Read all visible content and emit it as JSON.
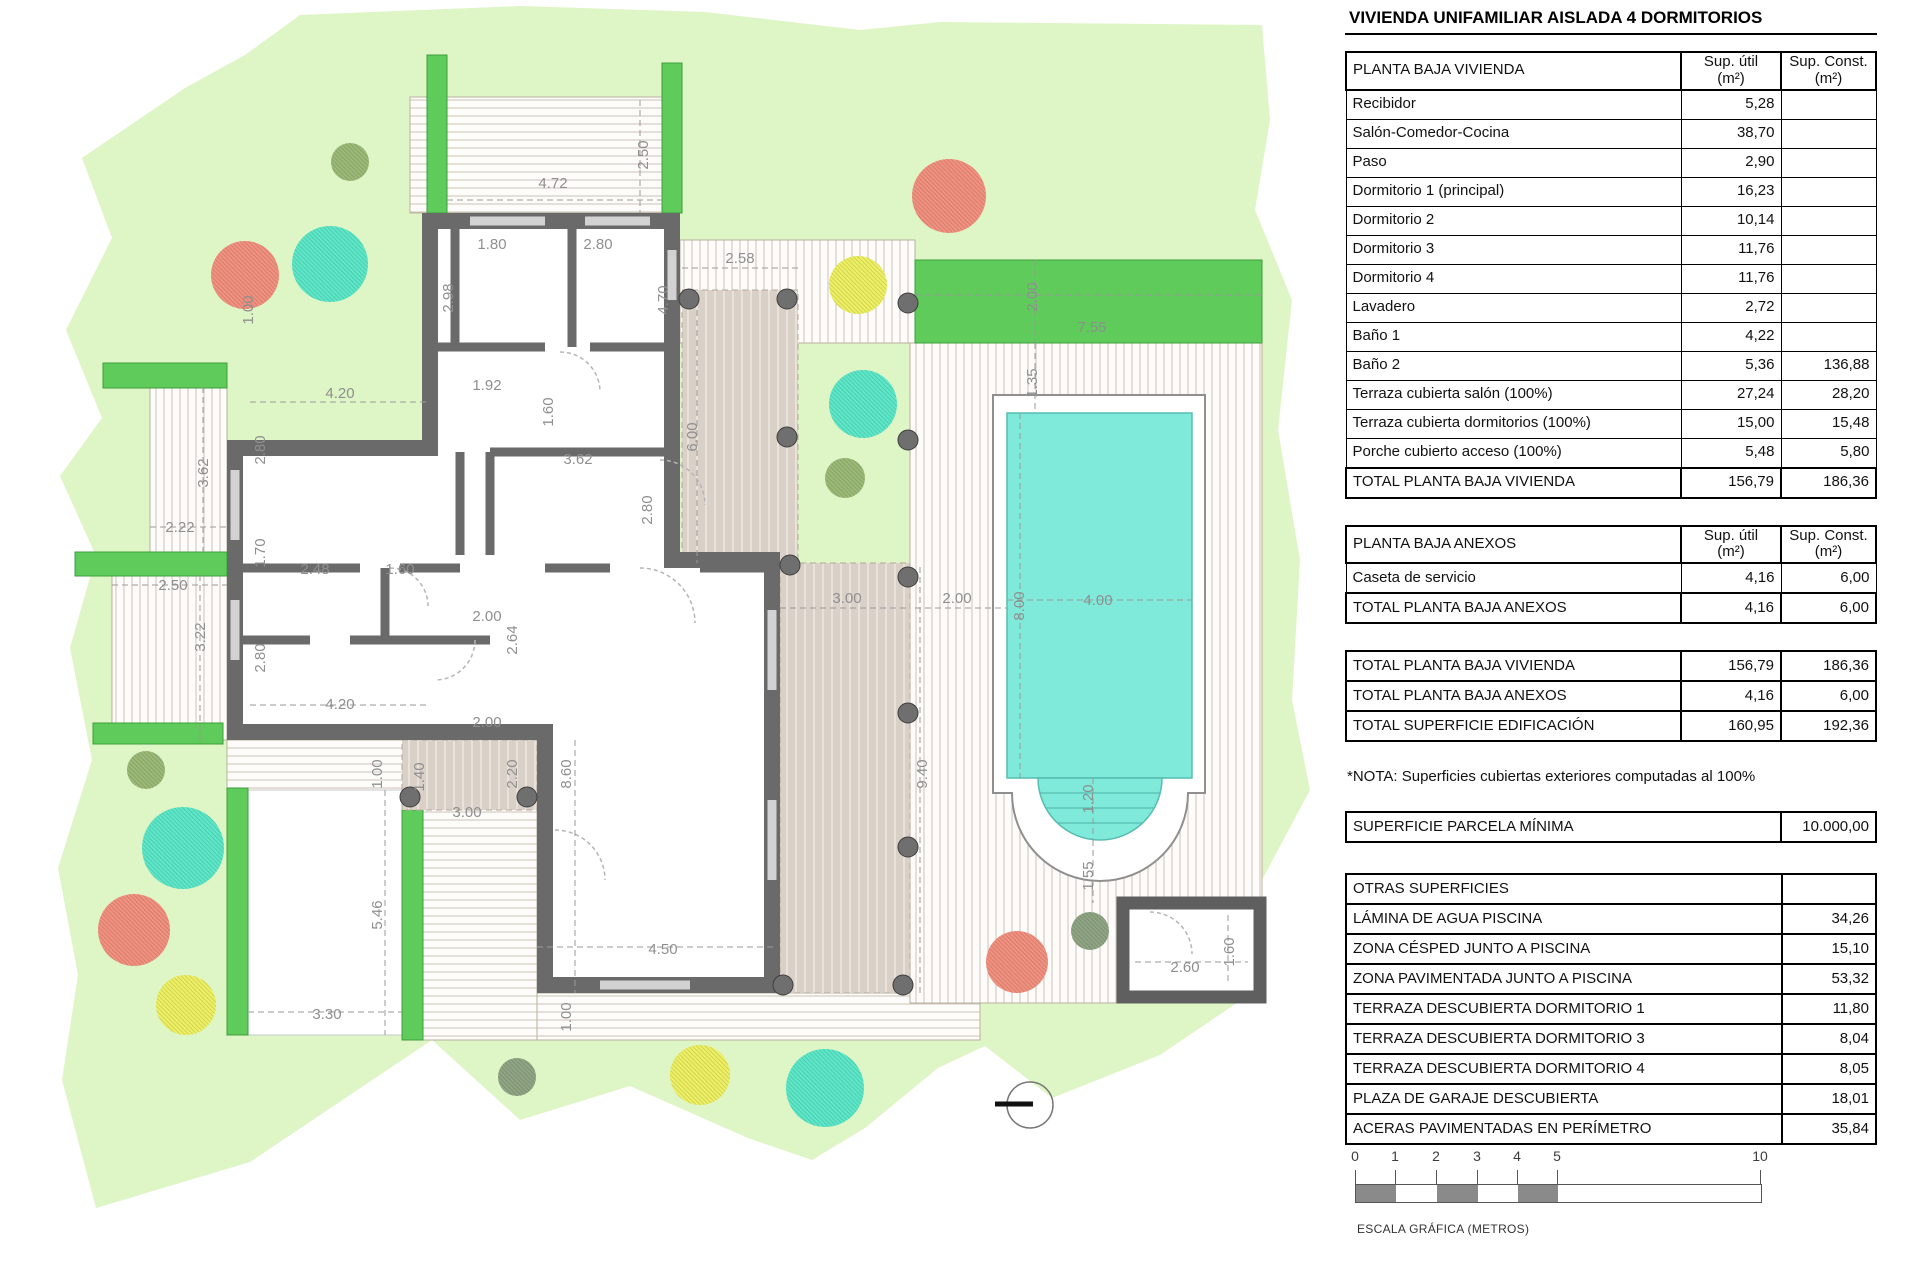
{
  "title": "VIVIENDA UNIFAMILIAR AISLADA 4 DORMITORIOS",
  "col_headers": {
    "util": "Sup. útil",
    "const": "Sup. Const.",
    "unit": "(m²)"
  },
  "planta_baja_vivienda": {
    "label": "PLANTA BAJA VIVIENDA",
    "rows": [
      {
        "label": "Recibidor",
        "util": "5,28",
        "const": ""
      },
      {
        "label": "Salón-Comedor-Cocina",
        "util": "38,70",
        "const": ""
      },
      {
        "label": "Paso",
        "util": "2,90",
        "const": ""
      },
      {
        "label": "Dormitorio 1 (principal)",
        "util": "16,23",
        "const": ""
      },
      {
        "label": "Dormitorio 2",
        "util": "10,14",
        "const": ""
      },
      {
        "label": "Dormitorio 3",
        "util": "11,76",
        "const": ""
      },
      {
        "label": "Dormitorio 4",
        "util": "11,76",
        "const": ""
      },
      {
        "label": "Lavadero",
        "util": "2,72",
        "const": ""
      },
      {
        "label": "Baño 1",
        "util": "4,22",
        "const": ""
      },
      {
        "label": "Baño 2",
        "util": "5,36",
        "const": "136,88"
      },
      {
        "label": "Terraza cubierta salón (100%)",
        "util": "27,24",
        "const": "28,20"
      },
      {
        "label": "Terraza cubierta dormitorios (100%)",
        "util": "15,00",
        "const": "15,48"
      },
      {
        "label": "Porche cubierto acceso (100%)",
        "util": "5,48",
        "const": "5,80"
      }
    ],
    "total": {
      "label": "TOTAL PLANTA BAJA VIVIENDA",
      "util": "156,79",
      "const": "186,36"
    }
  },
  "planta_baja_anexos": {
    "label": "PLANTA BAJA ANEXOS",
    "rows": [
      {
        "label": "Caseta de servicio",
        "util": "4,16",
        "const": "6,00"
      }
    ],
    "total": {
      "label": "TOTAL PLANTA BAJA ANEXOS",
      "util": "4,16",
      "const": "6,00"
    }
  },
  "resumen": {
    "rows": [
      {
        "label": "TOTAL PLANTA BAJA VIVIENDA",
        "util": "156,79",
        "const": "186,36",
        "hl": false
      },
      {
        "label": "TOTAL PLANTA BAJA ANEXOS",
        "util": "4,16",
        "const": "6,00",
        "hl": false
      },
      {
        "label": "TOTAL SUPERFICIE EDIFICACIÓN",
        "util": "160,95",
        "const": "192,36",
        "hl": true
      }
    ]
  },
  "nota": "*NOTA: Superficies cubiertas exteriores computadas al 100%",
  "parcela": {
    "label": "SUPERFICIE PARCELA MÍNIMA",
    "value": "10.000,00"
  },
  "otras": {
    "label": "OTRAS SUPERFICIES",
    "rows": [
      {
        "label": "LÁMINA DE AGUA PISCINA",
        "value": "34,26"
      },
      {
        "label": "ZONA CÉSPED JUNTO A PISCINA",
        "value": "15,10"
      },
      {
        "label": "ZONA PAVIMENTADA JUNTO A PISCINA",
        "value": "53,32"
      },
      {
        "label": "TERRAZA DESCUBIERTA DORMITORIO 1",
        "value": "11,80"
      },
      {
        "label": "TERRAZA DESCUBIERTA DORMITORIO 3",
        "value": "8,04"
      },
      {
        "label": "TERRAZA DESCUBIERTA DORMITORIO 4",
        "value": "8,05"
      },
      {
        "label": "PLAZA DE GARAJE DESCUBIERTA",
        "value": "18,01"
      },
      {
        "label": "ACERAS PAVIMENTADAS EN PERÍMETRO",
        "value": "35,84"
      }
    ]
  },
  "scalebar": {
    "ticks": [
      {
        "label": "0",
        "x": 0
      },
      {
        "label": "1",
        "x": 40
      },
      {
        "label": "2",
        "x": 81
      },
      {
        "label": "3",
        "x": 122
      },
      {
        "label": "4",
        "x": 162
      },
      {
        "label": "5",
        "x": 202
      },
      {
        "label": "10",
        "x": 405
      }
    ],
    "segments": [
      {
        "x": 0,
        "w": 40
      },
      {
        "x": 81,
        "w": 41
      },
      {
        "x": 162,
        "w": 40
      }
    ],
    "caption": "ESCALA GRÁFICA (METROS)"
  },
  "colors": {
    "lawn": "#def5c5",
    "hedge_green": "#5ecb5b",
    "pool_water": "#7feada",
    "wall_gray": "#6a6a6a",
    "table_beige": "#eae8d9",
    "table_blue": "#cfe9f3",
    "tree_red": "#f29180",
    "tree_teal": "#5ce8c8",
    "tree_yellow": "#eef063",
    "tree_olive": "#9cba77",
    "tree_olive2": "#8fa584"
  },
  "plan": {
    "dimensions": [
      {
        "t": "4.72",
        "x": 553,
        "y": 188,
        "r": 0
      },
      {
        "t": "2.50",
        "x": 648,
        "y": 155,
        "r": -90
      },
      {
        "t": "1.80",
        "x": 492,
        "y": 249,
        "r": 0
      },
      {
        "t": "2.80",
        "x": 598,
        "y": 249,
        "r": 0
      },
      {
        "t": "2.58",
        "x": 740,
        "y": 263,
        "r": 0
      },
      {
        "t": "2.98",
        "x": 453,
        "y": 298,
        "r": -90
      },
      {
        "t": "4.70",
        "x": 668,
        "y": 300,
        "r": -90
      },
      {
        "t": "1.00",
        "x": 253,
        "y": 310,
        "r": -90
      },
      {
        "t": "4.20",
        "x": 340,
        "y": 398,
        "r": 0
      },
      {
        "t": "1.92",
        "x": 487,
        "y": 390,
        "r": 0
      },
      {
        "t": "1.60",
        "x": 553,
        "y": 412,
        "r": -90
      },
      {
        "t": "6.00",
        "x": 697,
        "y": 437,
        "r": -90
      },
      {
        "t": "3.62",
        "x": 578,
        "y": 464,
        "r": 0
      },
      {
        "t": "2.80",
        "x": 265,
        "y": 450,
        "r": -90
      },
      {
        "t": "3.62",
        "x": 208,
        "y": 473,
        "r": -90
      },
      {
        "t": "2.80",
        "x": 652,
        "y": 510,
        "r": -90
      },
      {
        "t": "2.22",
        "x": 180,
        "y": 532,
        "r": 0
      },
      {
        "t": "1.70",
        "x": 265,
        "y": 553,
        "r": -90
      },
      {
        "t": "2.48",
        "x": 315,
        "y": 574,
        "r": 0
      },
      {
        "t": "1.60",
        "x": 400,
        "y": 574,
        "r": 0
      },
      {
        "t": "2.50",
        "x": 173,
        "y": 590,
        "r": 0
      },
      {
        "t": "2.00",
        "x": 487,
        "y": 621,
        "r": 0
      },
      {
        "t": "3.00",
        "x": 847,
        "y": 603,
        "r": 0
      },
      {
        "t": "2.00",
        "x": 957,
        "y": 603,
        "r": 0
      },
      {
        "t": "8.00",
        "x": 1024,
        "y": 606,
        "r": -90
      },
      {
        "t": "4.00",
        "x": 1098,
        "y": 605,
        "r": 0
      },
      {
        "t": "3.22",
        "x": 205,
        "y": 637,
        "r": -90
      },
      {
        "t": "2.80",
        "x": 265,
        "y": 658,
        "r": -90
      },
      {
        "t": "2.64",
        "x": 517,
        "y": 640,
        "r": -90
      },
      {
        "t": "4.20",
        "x": 340,
        "y": 709,
        "r": 0
      },
      {
        "t": "2.00",
        "x": 487,
        "y": 727,
        "r": 0
      },
      {
        "t": "9.40",
        "x": 927,
        "y": 774,
        "r": -90
      },
      {
        "t": "1.00",
        "x": 382,
        "y": 774,
        "r": -90
      },
      {
        "t": "1.40",
        "x": 424,
        "y": 777,
        "r": -90
      },
      {
        "t": "2.20",
        "x": 517,
        "y": 774,
        "r": -90
      },
      {
        "t": "8.60",
        "x": 571,
        "y": 774,
        "r": -90
      },
      {
        "t": "3.00",
        "x": 467,
        "y": 817,
        "r": 0
      },
      {
        "t": "5.46",
        "x": 382,
        "y": 915,
        "r": -90
      },
      {
        "t": "4.50",
        "x": 663,
        "y": 954,
        "r": 0
      },
      {
        "t": "1.20",
        "x": 1093,
        "y": 799,
        "r": -90
      },
      {
        "t": "1.55",
        "x": 1093,
        "y": 876,
        "r": -90
      },
      {
        "t": "2.60",
        "x": 1185,
        "y": 972,
        "r": 0
      },
      {
        "t": "1.60",
        "x": 1234,
        "y": 952,
        "r": -90
      },
      {
        "t": "3.30",
        "x": 327,
        "y": 1019,
        "r": 0
      },
      {
        "t": "1.00",
        "x": 571,
        "y": 1017,
        "r": -90
      },
      {
        "t": "7.55",
        "x": 1092,
        "y": 332,
        "r": 0
      },
      {
        "t": "2.00",
        "x": 1037,
        "y": 297,
        "r": -90
      },
      {
        "t": "1.35",
        "x": 1037,
        "y": 383,
        "r": -90
      }
    ],
    "trees": [
      {
        "x": 350,
        "y": 162,
        "r": 19,
        "c": "tree_olive"
      },
      {
        "x": 245,
        "y": 275,
        "r": 34,
        "c": "tree_red"
      },
      {
        "x": 330,
        "y": 264,
        "r": 38,
        "c": "tree_teal"
      },
      {
        "x": 949,
        "y": 196,
        "r": 37,
        "c": "tree_red"
      },
      {
        "x": 858,
        "y": 285,
        "r": 29,
        "c": "tree_yellow"
      },
      {
        "x": 863,
        "y": 404,
        "r": 34,
        "c": "tree_teal"
      },
      {
        "x": 845,
        "y": 478,
        "r": 20,
        "c": "tree_olive"
      },
      {
        "x": 146,
        "y": 770,
        "r": 19,
        "c": "tree_olive"
      },
      {
        "x": 183,
        "y": 848,
        "r": 41,
        "c": "tree_teal"
      },
      {
        "x": 134,
        "y": 930,
        "r": 36,
        "c": "tree_red"
      },
      {
        "x": 186,
        "y": 1005,
        "r": 30,
        "c": "tree_yellow"
      },
      {
        "x": 1017,
        "y": 962,
        "r": 31,
        "c": "tree_red"
      },
      {
        "x": 1090,
        "y": 931,
        "r": 19,
        "c": "tree_olive2"
      },
      {
        "x": 517,
        "y": 1077,
        "r": 19,
        "c": "tree_olive2"
      },
      {
        "x": 700,
        "y": 1075,
        "r": 30,
        "c": "tree_yellow"
      },
      {
        "x": 825,
        "y": 1088,
        "r": 39,
        "c": "tree_teal"
      }
    ],
    "columns": [
      [
        689,
        299
      ],
      [
        787,
        299
      ],
      [
        787,
        437
      ],
      [
        790,
        565
      ],
      [
        908,
        303
      ],
      [
        908,
        440
      ],
      [
        908,
        577
      ],
      [
        908,
        713
      ],
      [
        908,
        847
      ],
      [
        783,
        985
      ],
      [
        903,
        985
      ],
      [
        410,
        797
      ],
      [
        527,
        797
      ]
    ]
  }
}
